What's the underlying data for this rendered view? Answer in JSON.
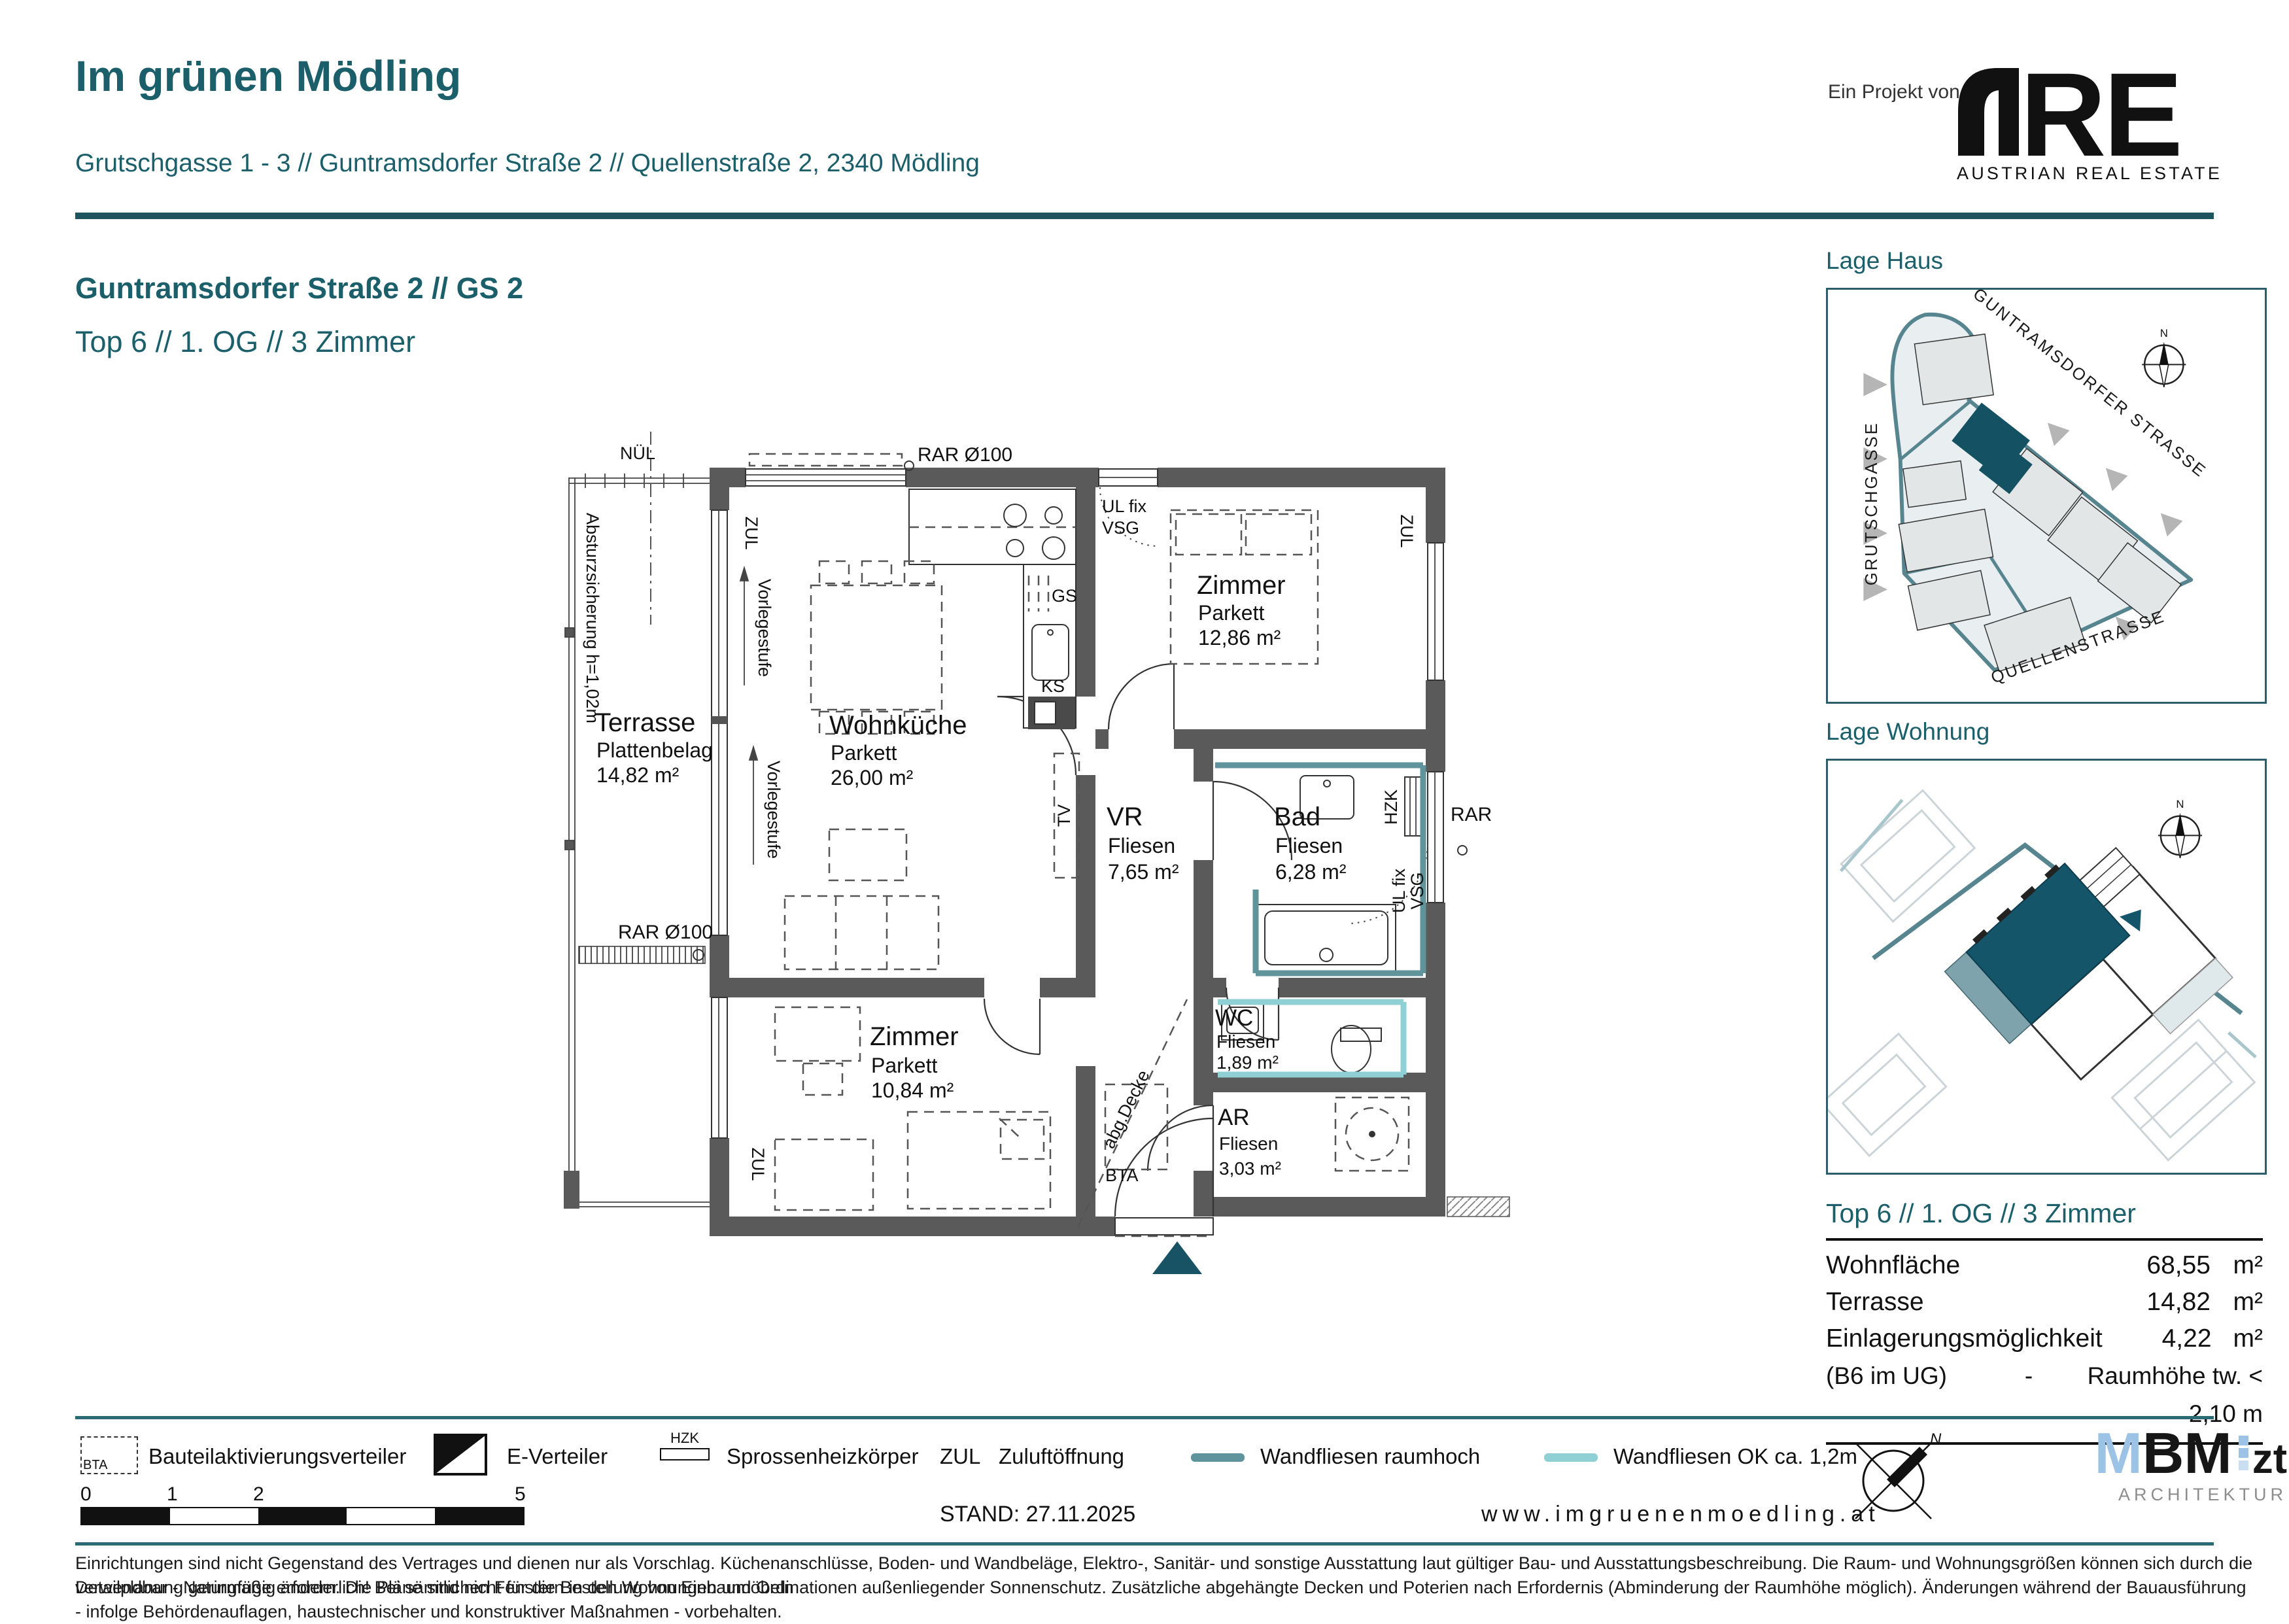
{
  "header": {
    "title": "Im grünen Mödling",
    "address": "Grutschgasse 1 - 3 // Guntramsdorfer Straße 2 // Quellenstraße 2, 2340 Mödling",
    "project_label": "Ein Projekt von",
    "are_logo": {
      "re": "RE",
      "subtitle": "AUSTRIAN REAL ESTATE",
      "green": "#a3c13a"
    }
  },
  "subheader": {
    "line1": "Guntramsdorfer Straße 2 // GS 2",
    "line2": "Top 6 // 1. OG // 3 Zimmer"
  },
  "plan": {
    "rooms": {
      "terrasse": {
        "name": "Terrasse",
        "floor": "Plattenbelag",
        "area": "14,82 m²"
      },
      "wohnkueche": {
        "name": "Wohnküche",
        "floor": "Parkett",
        "area": "26,00 m²"
      },
      "zimmer1": {
        "name": "Zimmer",
        "floor": "Parkett",
        "area": "12,86 m²"
      },
      "vr": {
        "name": "VR",
        "floor": "Fliesen",
        "area": "7,65 m²"
      },
      "bad": {
        "name": "Bad",
        "floor": "Fliesen",
        "area": "6,28 m²"
      },
      "wc": {
        "name": "WC",
        "floor": "Fliesen",
        "area": "1,89 m²"
      },
      "ar": {
        "name": "AR",
        "floor": "Fliesen",
        "area": "3,03 m²"
      },
      "zimmer2": {
        "name": "Zimmer",
        "floor": "Parkett",
        "area": "10,84 m²"
      }
    },
    "labels": {
      "nuel": "NÜL",
      "rar_d100": "RAR Ø100",
      "rar": "RAR",
      "zul": "ZUL",
      "vorlegestufe": "Vorlegestufe",
      "absturz": "Absturzsicherung h=1,02m",
      "ul_fix": "UL fix",
      "vsg": "VSG",
      "gs": "GS",
      "ks": "KS",
      "tv": "TV",
      "hzk": "HZK",
      "bta": "BTA",
      "abg_decke": "abg.Decke"
    }
  },
  "sidebar": {
    "lage_haus": {
      "title": "Lage Haus",
      "streets": {
        "guntramsdorfer": "GUNTRAMSDORFER STRASSE",
        "grutschgasse": "GRUTSCHGASSE",
        "quellenstrasse": "QUELLENSTRASSE"
      },
      "compass_n": "N"
    },
    "lage_wohnung": {
      "title": "Lage Wohnung",
      "compass_n": "N"
    },
    "info": {
      "title": "Top 6 // 1. OG // 3 Zimmer",
      "rows": [
        {
          "label": "Wohnfläche",
          "value": "68,55",
          "unit": "m²"
        },
        {
          "label": "Terrasse",
          "value": "14,82",
          "unit": "m²"
        },
        {
          "label": "Einlagerungsmöglichkeit",
          "value": "4,22",
          "unit": "m²"
        }
      ],
      "note": {
        "label": "(B6 im UG)",
        "dash": "-",
        "text": "Raumhöhe tw. < 2,10 m"
      }
    }
  },
  "footer": {
    "legend": {
      "bta_symbol": "BTA",
      "bta": "Bauteilaktivierungsverteiler",
      "e_verteiler": "E-Verteiler",
      "hzk_symbol": "HZK",
      "hzk": "Sprossenheizkörper",
      "zul_symbol": "ZUL",
      "zul": "Zuluftöffnung",
      "wandfliesen_hoch": "Wandfliesen raumhoch",
      "wandfliesen_ok": "Wandfliesen OK ca. 1,2m"
    },
    "scale": {
      "t0": "0",
      "t1": "1",
      "t2": "2",
      "t5": "5"
    },
    "stand": "STAND: 27.11.2025",
    "website": "www.imgruenenmoedling.at",
    "mbm": {
      "m": "M",
      "bm": "BM",
      "zt": "zt",
      "subtitle": "ARCHITEKTUR"
    }
  },
  "disclaimer": {
    "line1": "Einrichtungen sind nicht Gegenstand des Vertrages und dienen nur als Vorschlag. Küchenanschlüsse, Boden- und Wandbeläge, Elektro-, Sanitär- und sonstige Ausstattung laut gültiger Bau- und Ausstattungsbeschreibung. Die Raum- und Wohnungsgrößen können sich durch die Detailplanung geringfügig ändern. Die Pläne sind nicht für die Bestellung von Einbaumöbeln",
    "line2": "verwendbar - Naturmaße erforderlich! Bei sämtlichen Fenstern in den Wohnungen und Ordinationen außenliegender Sonnenschutz. Zusätzliche abgehängte Decken und Poterien nach Erfordernis (Abminderung der Raumhöhe möglich). Änderungen während der Bauausführung - infolge Behördenauflagen, haustechnischer und konstruktiver Maßnahmen - vorbehalten."
  },
  "colors": {
    "heading_teal": "#1b5f6b",
    "divider_teal": "#1d545e",
    "wall_gray": "#5a5a5a",
    "tile_raumhoch": "#5f949c",
    "tile_ok12": "#8fd0d4",
    "unit_highlight": "#145263",
    "map_outline": "#57858f",
    "are_green": "#a3c13a",
    "mbm_blue": "#9cc3e5"
  }
}
